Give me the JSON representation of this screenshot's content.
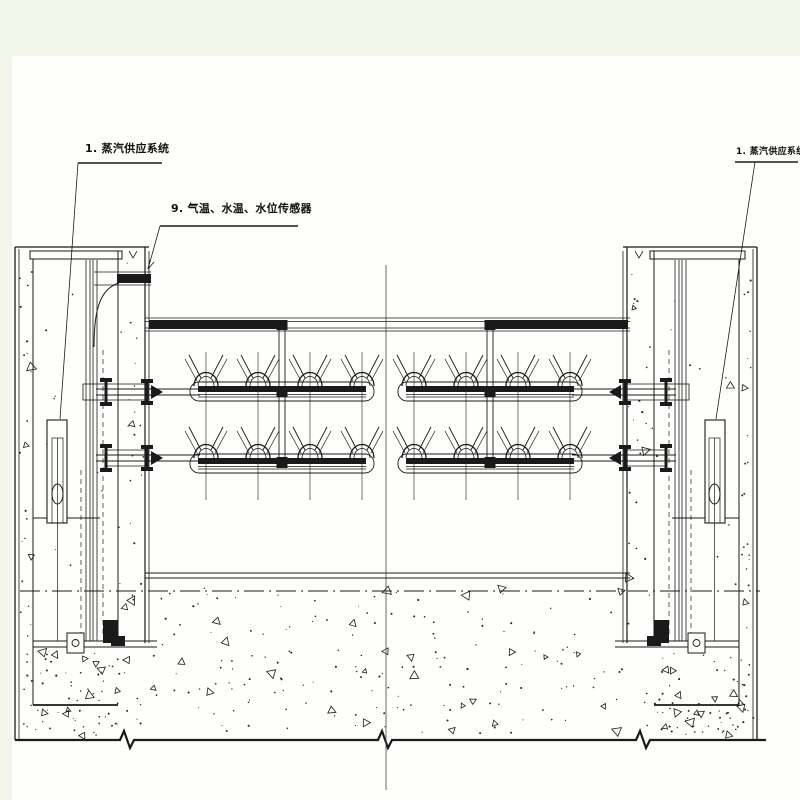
{
  "labels": {
    "steam_supply_left": "1. 蒸汽供应系统",
    "sensors": "9. 气温、水温、水位传感器",
    "steam_supply_right": "1. 蒸汽供应系统"
  },
  "colors": {
    "page_bg": "#f2f5e9",
    "paper_bg": "#fefefc",
    "line": "#1a1a1a",
    "centerline": "#444444"
  }
}
